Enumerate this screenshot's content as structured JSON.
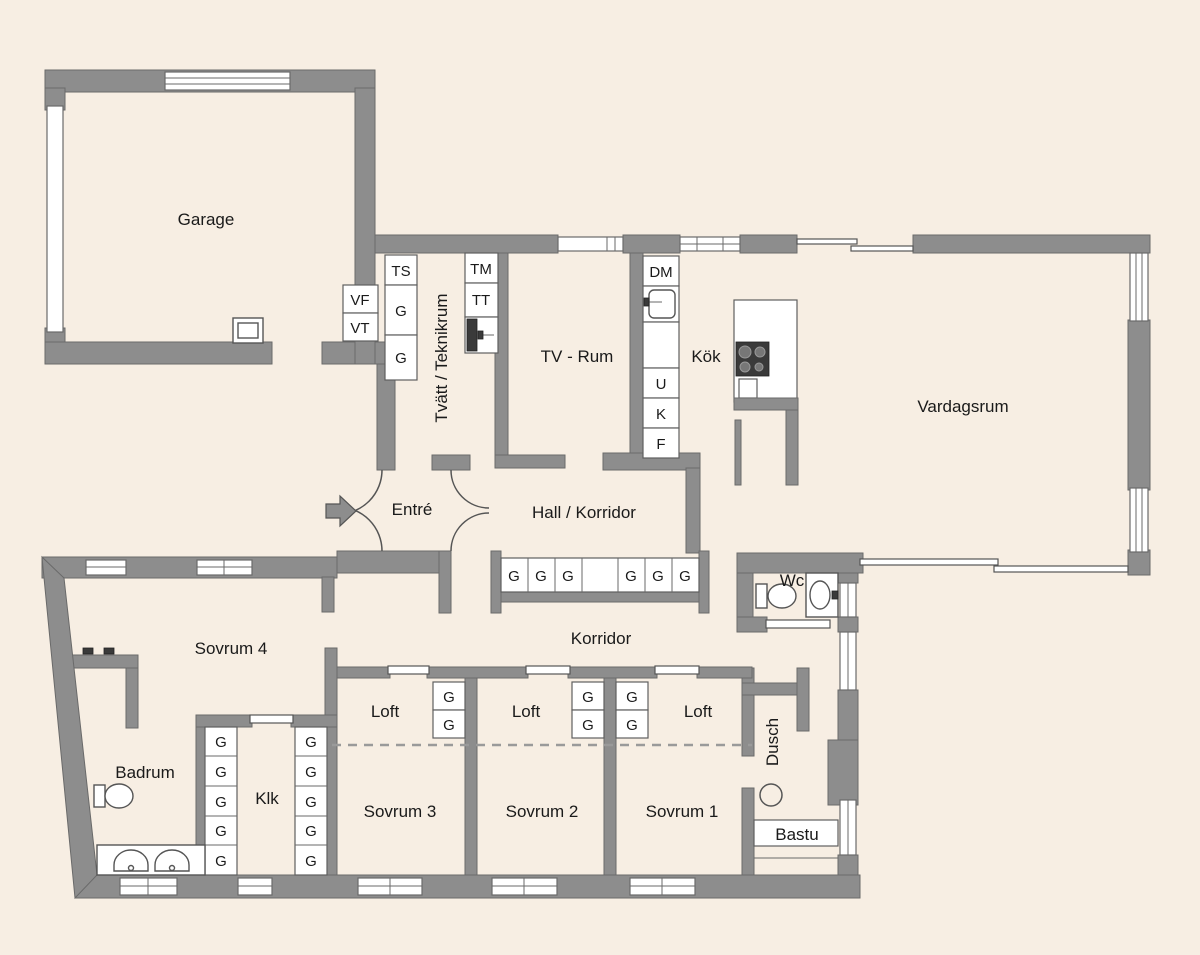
{
  "title": "Floor plan",
  "colors": {
    "background": "#f7eee3",
    "wall": "#8d8d8d",
    "wall_edge": "#6a6a6a",
    "fixture_white": "#ffffff",
    "text": "#1a1a1a"
  },
  "rooms": {
    "garage": "Garage",
    "tvatt": "Tvätt / Teknikrum",
    "tvrum": "TV - Rum",
    "kok": "Kök",
    "vardagsrum": "Vardagsrum",
    "entre": "Entré",
    "hall": "Hall / Korridor",
    "korridor": "Korridor",
    "sovrum4": "Sovrum 4",
    "badrum": "Badrum",
    "klk": "Klk",
    "loft": "Loft",
    "sovrum3": "Sovrum 3",
    "sovrum2": "Sovrum 2",
    "sovrum1": "Sovrum 1",
    "dusch": "Dusch",
    "bastu": "Bastu",
    "wc": "Wc"
  },
  "closets": {
    "ts": "TS",
    "g": "G",
    "vf": "VF",
    "vt": "VT",
    "tm": "TM",
    "tt": "TT",
    "dm": "DM",
    "u": "U",
    "k": "K",
    "f": "F"
  }
}
